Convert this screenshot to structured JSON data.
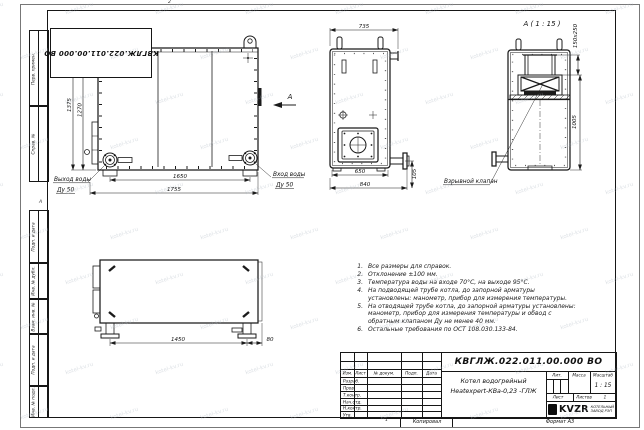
{
  "doc": {
    "stamp_number": "КВГЛЖ.022.011.00.000 ВО"
  },
  "watermark": {
    "text": "kotel-kv.ru"
  },
  "frame": {
    "margin_cells": [
      {
        "label": "Перв. примен."
      },
      {
        "label": "Справ. №"
      },
      {
        "label": "Подп. и дата"
      },
      {
        "label": "Инв. № дубл."
      },
      {
        "label": "Взам. инв. №"
      },
      {
        "label": "Подп. и дата"
      },
      {
        "label": "Инв. № подл."
      }
    ],
    "zone_letter": "А",
    "top_tick": "2",
    "bottom_tick": "1",
    "footer": {
      "copied": "Копировал",
      "format": "Формат А3"
    }
  },
  "front_view": {
    "dim_height_outer": "1375",
    "dim_height_inner": "1270",
    "dim_width_inner": "1650",
    "dim_width_outer": "1755",
    "outlet_label": "Выход воды",
    "outlet_dn": "Ду 50",
    "inlet_label": "Вход воды",
    "inlet_dn": "Ду 50",
    "section_arrow": "А"
  },
  "side_view": {
    "dim_top": "735",
    "dim_bottom_inner": "650",
    "dim_bottom_outer": "840",
    "dim_right": "105"
  },
  "detail_view": {
    "title": "А ( 1 : 15 )",
    "dim_flue": "150x250",
    "dim_height": "1005",
    "valve_label": "Взрывной клапан"
  },
  "top_view": {
    "dim_width": "1450",
    "dim_offset": "80"
  },
  "notes": [
    {
      "num": "1.",
      "text": "Все размеры для справок."
    },
    {
      "num": "2.",
      "text": "Отклонение ±100 мм."
    },
    {
      "num": "3.",
      "text": "Температура воды на входе 70°С, на выходе 95°С."
    },
    {
      "num": "4.",
      "text": "На подводящей трубе котла, до запорной арматуры установлены: манометр, прибор для измерения температуры."
    },
    {
      "num": "5.",
      "text": "На отводящей трубе котла, до запорной арматуры установлены: манометр, прибор для измерения температуры и обвод с обратным клапаном Ду не менее 40 мм."
    },
    {
      "num": "6.",
      "text": "Остальные требования по ОСТ 108.030.133-84."
    }
  ],
  "title_block": {
    "number": "КВГЛЖ.022.011.00.000 ВО",
    "columns": [
      "Изм.",
      "Лист",
      "№ докум.",
      "Подп.",
      "Дата"
    ],
    "rows": [
      "Разраб.",
      "Пров.",
      "Т.контр.",
      "Нач.отд.",
      "Н.контр.",
      "Утв."
    ],
    "name_line1": "Котел водогрейный",
    "name_line2": "Heatexpert-КВа-0,23 -ГЛЖ",
    "lit_label": "Лит.",
    "mass_label": "Масса",
    "scale_label": "Масштаб",
    "scale_value": "1 : 15",
    "sheet_label": "Лист",
    "sheets_label": "Листов",
    "sheets_value": "1",
    "logo_text": "KVZR",
    "org_line1": "КОТЕЛЬНЫЙ",
    "org_line2": "ЗАВОД РЭП"
  }
}
